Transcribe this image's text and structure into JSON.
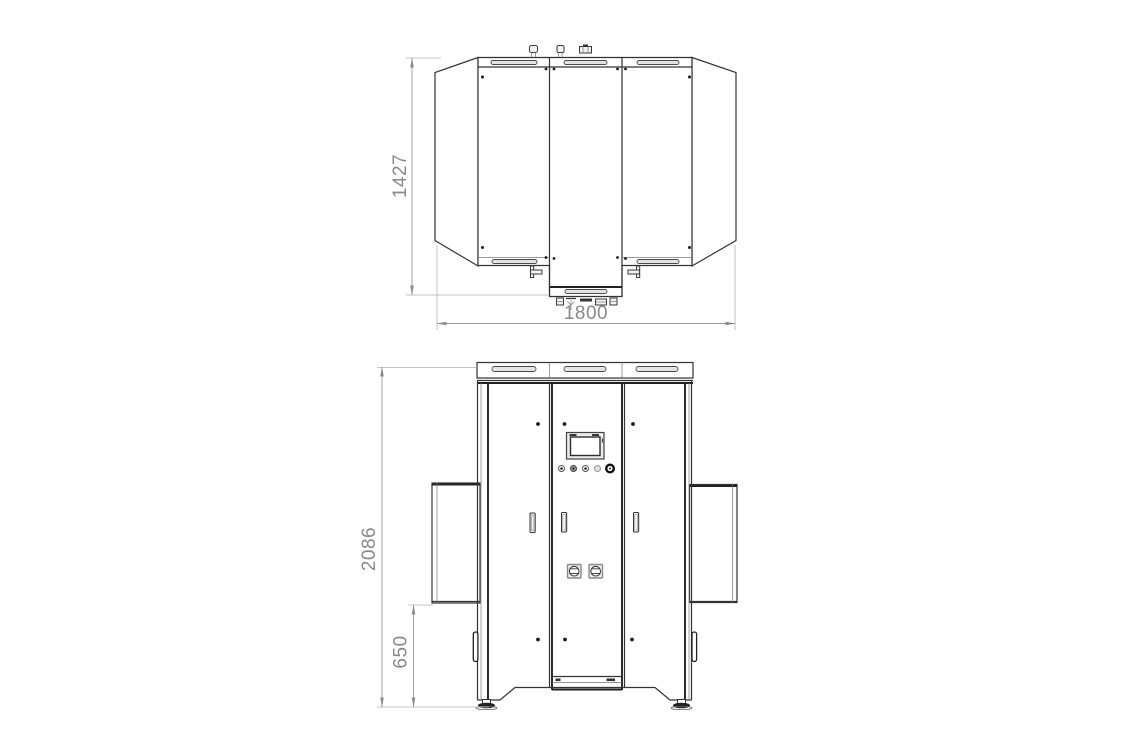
{
  "drawing": {
    "kind": "machine-outline-dimension-drawing",
    "views": {
      "top_view": {
        "depth_label": "1427",
        "width_label": "1800"
      },
      "front_view": {
        "height_label": "2086",
        "base_height_label": "650"
      }
    }
  },
  "colors": {
    "line": "#333333",
    "dimension_line": "#999999",
    "extension_line": "#b3b3b3",
    "dimension_text": "#8a8a8a",
    "background": "#ffffff"
  }
}
